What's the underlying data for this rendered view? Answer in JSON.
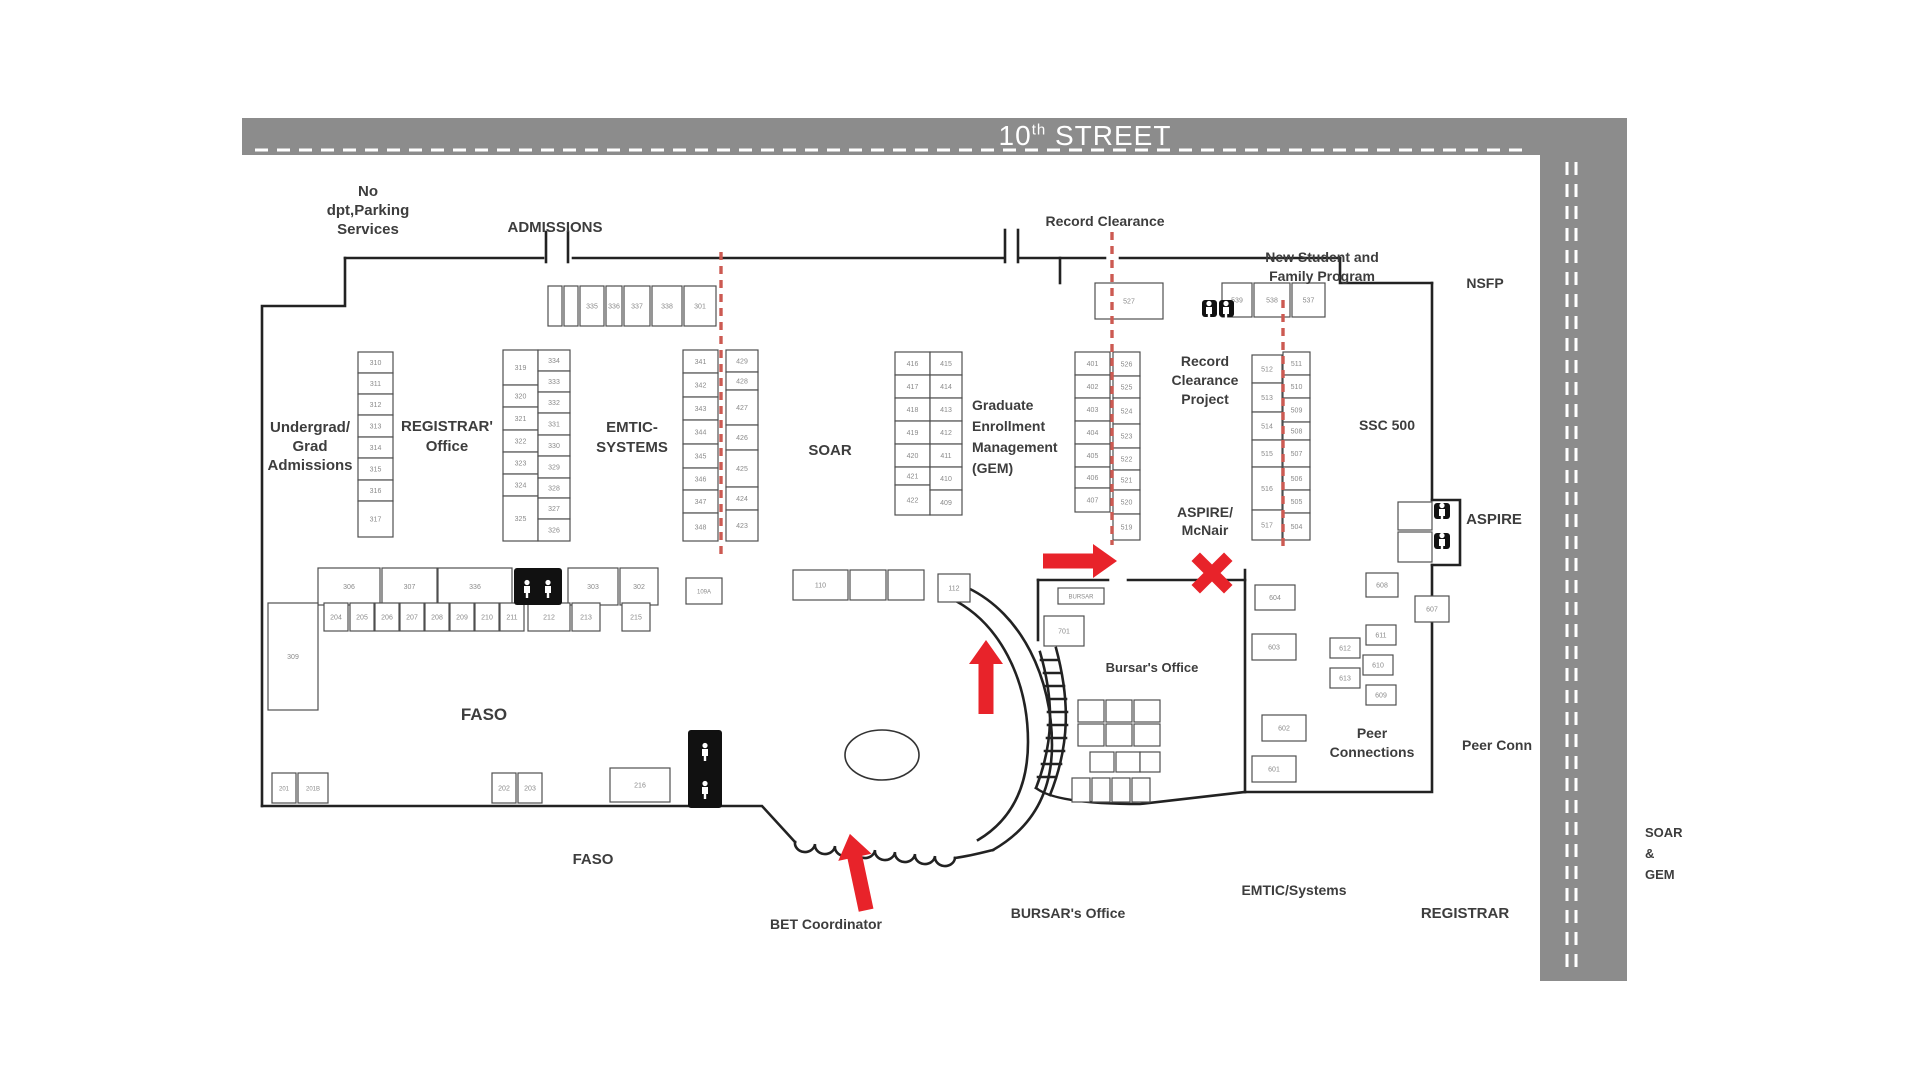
{
  "colors": {
    "road": "#8c8c8c",
    "wall": "#222222",
    "room_stroke": "#4f4f4f",
    "room_text": "#8a8a8a",
    "label": "#3d3d3d",
    "red": "#e8232a",
    "red_dash": "#cc5a52",
    "white": "#ffffff"
  },
  "street": {
    "number": "10",
    "sup": "th",
    "name": " STREET"
  },
  "roads": {
    "top": {
      "x": 242,
      "y": 118,
      "w": 1385,
      "h": 37
    },
    "right": {
      "x": 1540,
      "y": 118,
      "w": 87,
      "h": 863
    }
  },
  "road_dashes": [
    {
      "x1": 255,
      "y1": 150,
      "x2": 1530,
      "y2": 150
    },
    {
      "x1": 1567,
      "y1": 162,
      "x2": 1567,
      "y2": 975
    },
    {
      "x1": 1576,
      "y1": 162,
      "x2": 1576,
      "y2": 975
    }
  ],
  "area_labels": [
    {
      "id": "no-dpt-parking-services",
      "x": 368,
      "y": 196,
      "lh": 19,
      "size": 15,
      "align": "middle",
      "lines": [
        "No",
        "dpt,Parking",
        "Services"
      ]
    },
    {
      "id": "admissions",
      "x": 555,
      "y": 232,
      "lh": 19,
      "size": 15,
      "align": "middle",
      "lines": [
        "ADMISSIONS"
      ]
    },
    {
      "id": "record-clearance",
      "x": 1105,
      "y": 226,
      "lh": 18,
      "size": 14,
      "align": "middle",
      "lines": [
        "Record Clearance"
      ]
    },
    {
      "id": "new-student-family-program",
      "x": 1322,
      "y": 262,
      "lh": 19,
      "size": 14,
      "align": "middle",
      "lines": [
        "New Student and",
        "Family Program"
      ]
    },
    {
      "id": "nsfp",
      "x": 1485,
      "y": 288,
      "lh": 18,
      "size": 14,
      "align": "middle",
      "lines": [
        "NSFP"
      ]
    },
    {
      "id": "undergrad-grad-admissions",
      "x": 310,
      "y": 432,
      "lh": 19,
      "size": 15,
      "align": "middle",
      "lines": [
        "Undergrad/",
        "Grad",
        "Admissions"
      ]
    },
    {
      "id": "registrar-office",
      "x": 447,
      "y": 431,
      "lh": 20,
      "size": 15,
      "align": "middle",
      "lines": [
        "REGISTRAR'",
        "Office"
      ]
    },
    {
      "id": "emtic-systems",
      "x": 632,
      "y": 432,
      "lh": 20,
      "size": 15,
      "align": "middle",
      "lines": [
        "EMTIC-",
        "SYSTEMS"
      ]
    },
    {
      "id": "soar",
      "x": 830,
      "y": 455,
      "lh": 19,
      "size": 15,
      "align": "middle",
      "lines": [
        "SOAR"
      ]
    },
    {
      "id": "gem",
      "x": 972,
      "y": 410,
      "lh": 21,
      "size": 14,
      "align": "start",
      "lines": [
        "Graduate",
        "Enrollment",
        "Management",
        "(GEM)"
      ]
    },
    {
      "id": "record-clearance-project",
      "x": 1205,
      "y": 366,
      "lh": 19,
      "size": 14,
      "align": "middle",
      "lines": [
        "Record",
        "Clearance",
        "Project"
      ]
    },
    {
      "id": "ssc-500",
      "x": 1387,
      "y": 430,
      "lh": 18,
      "size": 14,
      "align": "middle",
      "lines": [
        "SSC 500"
      ]
    },
    {
      "id": "aspire-mcnair",
      "x": 1205,
      "y": 517,
      "lh": 18,
      "size": 14,
      "align": "middle",
      "lines": [
        "ASPIRE/",
        "McNair"
      ]
    },
    {
      "id": "aspire",
      "x": 1494,
      "y": 524,
      "lh": 18,
      "size": 15,
      "align": "middle",
      "lines": [
        "ASPIRE"
      ]
    },
    {
      "id": "bursars-office-mid",
      "x": 1152,
      "y": 672,
      "lh": 17,
      "size": 13,
      "align": "middle",
      "lines": [
        "Bursar's Office"
      ]
    },
    {
      "id": "peer-connections",
      "x": 1372,
      "y": 738,
      "lh": 19,
      "size": 14,
      "align": "middle",
      "lines": [
        "Peer",
        "Connections"
      ]
    },
    {
      "id": "peer-conn",
      "x": 1497,
      "y": 750,
      "lh": 18,
      "size": 14,
      "align": "middle",
      "lines": [
        "Peer Conn"
      ]
    },
    {
      "id": "faso",
      "x": 484,
      "y": 720,
      "lh": 20,
      "size": 17,
      "align": "middle",
      "lines": [
        "FASO"
      ]
    },
    {
      "id": "faso-2",
      "x": 593,
      "y": 864,
      "lh": 18,
      "size": 15,
      "align": "middle",
      "lines": [
        "FASO"
      ]
    },
    {
      "id": "bet-coordinator",
      "x": 826,
      "y": 929,
      "lh": 18,
      "size": 14,
      "align": "middle",
      "lines": [
        "BET Coordinator"
      ]
    },
    {
      "id": "bursars-office-bottom",
      "x": 1068,
      "y": 918,
      "lh": 18,
      "size": 14,
      "align": "middle",
      "lines": [
        "BURSAR's Office"
      ]
    },
    {
      "id": "emtic-systems-bottom",
      "x": 1294,
      "y": 895,
      "lh": 18,
      "size": 14,
      "align": "middle",
      "lines": [
        "EMTIC/Systems"
      ]
    },
    {
      "id": "registrar-bottom",
      "x": 1465,
      "y": 918,
      "lh": 18,
      "size": 15,
      "align": "middle",
      "lines": [
        "REGISTRAR"
      ]
    },
    {
      "id": "soar-gem",
      "x": 1645,
      "y": 837,
      "lh": 21,
      "size": 13,
      "align": "start",
      "lines": [
        "SOAR",
        "&",
        "GEM"
      ]
    }
  ],
  "rooms": [
    [
      "335",
      580,
      286,
      24,
      40
    ],
    [
      "336",
      606,
      286,
      16,
      40
    ],
    [
      "337",
      624,
      286,
      26,
      40
    ],
    [
      "338",
      652,
      286,
      30,
      40
    ],
    [
      "301",
      684,
      286,
      32,
      40
    ],
    [
      "310",
      358,
      352,
      35,
      21
    ],
    [
      "311",
      358,
      373,
      35,
      21
    ],
    [
      "312",
      358,
      394,
      35,
      21
    ],
    [
      "313",
      358,
      415,
      35,
      22
    ],
    [
      "314",
      358,
      437,
      35,
      21
    ],
    [
      "315",
      358,
      458,
      35,
      22
    ],
    [
      "316",
      358,
      480,
      35,
      21
    ],
    [
      "317",
      358,
      501,
      35,
      36
    ],
    [
      "319",
      503,
      350,
      35,
      35
    ],
    [
      "320",
      503,
      385,
      35,
      22
    ],
    [
      "321",
      503,
      407,
      35,
      23
    ],
    [
      "322",
      503,
      430,
      35,
      22
    ],
    [
      "323",
      503,
      452,
      35,
      22
    ],
    [
      "324",
      503,
      474,
      35,
      22
    ],
    [
      "325",
      503,
      496,
      35,
      45
    ],
    [
      "334",
      538,
      350,
      32,
      21
    ],
    [
      "333",
      538,
      371,
      32,
      21
    ],
    [
      "332",
      538,
      392,
      32,
      21
    ],
    [
      "331",
      538,
      413,
      32,
      22
    ],
    [
      "330",
      538,
      435,
      32,
      21
    ],
    [
      "329",
      538,
      456,
      32,
      22
    ],
    [
      "328",
      538,
      478,
      32,
      20
    ],
    [
      "327",
      538,
      498,
      32,
      21
    ],
    [
      "326",
      538,
      519,
      32,
      22
    ],
    [
      "341",
      683,
      350,
      35,
      23
    ],
    [
      "342",
      683,
      373,
      35,
      24
    ],
    [
      "343",
      683,
      397,
      35,
      23
    ],
    [
      "344",
      683,
      420,
      35,
      24
    ],
    [
      "345",
      683,
      444,
      35,
      24
    ],
    [
      "346",
      683,
      468,
      35,
      22
    ],
    [
      "347",
      683,
      490,
      35,
      23
    ],
    [
      "348",
      683,
      513,
      35,
      28
    ],
    [
      "429",
      726,
      350,
      32,
      22
    ],
    [
      "428",
      726,
      372,
      32,
      18
    ],
    [
      "427",
      726,
      390,
      32,
      35
    ],
    [
      "426",
      726,
      425,
      32,
      25
    ],
    [
      "425",
      726,
      450,
      32,
      37
    ],
    [
      "424",
      726,
      487,
      32,
      23
    ],
    [
      "423",
      726,
      510,
      32,
      31
    ],
    [
      "416",
      895,
      352,
      35,
      23
    ],
    [
      "417",
      895,
      375,
      35,
      23
    ],
    [
      "418",
      895,
      398,
      35,
      23
    ],
    [
      "419",
      895,
      421,
      35,
      23
    ],
    [
      "420",
      895,
      444,
      35,
      23
    ],
    [
      "421",
      895,
      467,
      35,
      18
    ],
    [
      "422",
      895,
      485,
      35,
      30
    ],
    [
      "415",
      930,
      352,
      32,
      23
    ],
    [
      "414",
      930,
      375,
      32,
      23
    ],
    [
      "413",
      930,
      398,
      32,
      23
    ],
    [
      "412",
      930,
      421,
      32,
      23
    ],
    [
      "411",
      930,
      444,
      32,
      23
    ],
    [
      "410",
      930,
      467,
      32,
      23
    ],
    [
      "409",
      930,
      490,
      32,
      25
    ],
    [
      "401",
      1075,
      352,
      35,
      23
    ],
    [
      "402",
      1075,
      375,
      35,
      23
    ],
    [
      "403",
      1075,
      398,
      35,
      23
    ],
    [
      "404",
      1075,
      421,
      35,
      23
    ],
    [
      "405",
      1075,
      444,
      35,
      23
    ],
    [
      "406",
      1075,
      467,
      35,
      21
    ],
    [
      "407",
      1075,
      488,
      35,
      24
    ],
    [
      "526",
      1113,
      352,
      27,
      24
    ],
    [
      "525",
      1113,
      376,
      27,
      22
    ],
    [
      "524",
      1113,
      398,
      27,
      26
    ],
    [
      "523",
      1113,
      424,
      27,
      24
    ],
    [
      "522",
      1113,
      448,
      27,
      22
    ],
    [
      "521",
      1113,
      470,
      27,
      20
    ],
    [
      "520",
      1113,
      490,
      27,
      24
    ],
    [
      "519",
      1113,
      514,
      27,
      26
    ],
    [
      "527",
      1095,
      283,
      68,
      36
    ],
    [
      "539",
      1222,
      283,
      30,
      34
    ],
    [
      "538",
      1254,
      283,
      36,
      34
    ],
    [
      "537",
      1292,
      283,
      33,
      34
    ],
    [
      "512",
      1252,
      355,
      30,
      28
    ],
    [
      "513",
      1252,
      383,
      30,
      29
    ],
    [
      "514",
      1252,
      412,
      30,
      28
    ],
    [
      "515",
      1252,
      440,
      30,
      27
    ],
    [
      "516",
      1252,
      467,
      30,
      43
    ],
    [
      "517",
      1252,
      510,
      30,
      30
    ],
    [
      "511",
      1283,
      352,
      27,
      23
    ],
    [
      "510",
      1283,
      375,
      27,
      23
    ],
    [
      "509",
      1283,
      398,
      27,
      24
    ],
    [
      "508",
      1283,
      422,
      27,
      18
    ],
    [
      "507",
      1283,
      440,
      27,
      27
    ],
    [
      "506",
      1283,
      467,
      27,
      23
    ],
    [
      "505",
      1283,
      490,
      27,
      23
    ],
    [
      "504",
      1283,
      513,
      27,
      27
    ],
    [
      "306",
      318,
      568,
      62,
      37
    ],
    [
      "307",
      382,
      568,
      55,
      37
    ],
    [
      "336",
      438,
      568,
      74,
      37
    ],
    [
      "303",
      568,
      568,
      50,
      37
    ],
    [
      "302",
      620,
      568,
      38,
      37
    ],
    [
      "109A",
      686,
      578,
      36,
      26,
      6
    ],
    [
      "204",
      324,
      603,
      24,
      28
    ],
    [
      "205",
      350,
      603,
      24,
      28
    ],
    [
      "206",
      375,
      603,
      24,
      28
    ],
    [
      "207",
      400,
      603,
      24,
      28
    ],
    [
      "208",
      425,
      603,
      24,
      28
    ],
    [
      "209",
      450,
      603,
      24,
      28
    ],
    [
      "210",
      475,
      603,
      24,
      28
    ],
    [
      "211",
      500,
      603,
      24,
      28
    ],
    [
      "212",
      528,
      603,
      42,
      28
    ],
    [
      "213",
      572,
      603,
      28,
      28
    ],
    [
      "215",
      622,
      603,
      28,
      28
    ],
    [
      "309",
      268,
      603,
      50,
      107
    ],
    [
      "201",
      272,
      773,
      24,
      30,
      6
    ],
    [
      "201B",
      298,
      773,
      30,
      30,
      6
    ],
    [
      "202",
      492,
      773,
      24,
      30
    ],
    [
      "203",
      518,
      773,
      24,
      30
    ],
    [
      "216",
      610,
      768,
      60,
      34
    ],
    [
      "110",
      793,
      570,
      55,
      30
    ],
    [
      "112",
      938,
      574,
      32,
      28
    ],
    [
      "701",
      1044,
      616,
      40,
      30
    ],
    [
      "BURSAR",
      1058,
      588,
      46,
      16,
      6
    ],
    [
      "604",
      1255,
      585,
      40,
      25
    ],
    [
      "608",
      1366,
      573,
      32,
      24
    ],
    [
      "607",
      1415,
      596,
      34,
      26
    ],
    [
      "603",
      1252,
      634,
      44,
      26
    ],
    [
      "611",
      1366,
      625,
      30,
      20
    ],
    [
      "612",
      1330,
      638,
      30,
      20
    ],
    [
      "610",
      1363,
      655,
      30,
      20
    ],
    [
      "613",
      1330,
      668,
      30,
      20
    ],
    [
      "609",
      1366,
      685,
      30,
      20
    ],
    [
      "602",
      1262,
      715,
      44,
      26
    ],
    [
      "601",
      1252,
      756,
      44,
      26
    ]
  ],
  "cells": [
    [
      548,
      286,
      14,
      40
    ],
    [
      564,
      286,
      14,
      40
    ],
    [
      850,
      570,
      36,
      30
    ],
    [
      888,
      570,
      36,
      30
    ],
    [
      1078,
      700,
      26,
      22
    ],
    [
      1106,
      700,
      26,
      22
    ],
    [
      1134,
      700,
      26,
      22
    ],
    [
      1078,
      724,
      26,
      22
    ],
    [
      1106,
      724,
      26,
      22
    ],
    [
      1134,
      724,
      26,
      22
    ],
    [
      1090,
      752,
      24,
      20
    ],
    [
      1116,
      752,
      24,
      20
    ],
    [
      1140,
      752,
      20,
      20
    ],
    [
      1072,
      778,
      18,
      24
    ],
    [
      1092,
      778,
      18,
      24
    ],
    [
      1112,
      778,
      18,
      24
    ],
    [
      1132,
      778,
      18,
      24
    ],
    [
      1398,
      502,
      34,
      28
    ],
    [
      1398,
      532,
      34,
      30
    ]
  ],
  "restrooms": [
    {
      "x": 514,
      "y": 568,
      "w": 48,
      "h": 37,
      "figs": [
        [
          527,
          589
        ],
        [
          548,
          589
        ]
      ]
    },
    {
      "x": 688,
      "y": 730,
      "w": 34,
      "h": 78,
      "figs": [
        [
          705,
          752
        ],
        [
          705,
          790
        ]
      ]
    },
    {
      "x": 1202,
      "y": 300,
      "w": 15,
      "h": 17,
      "figs": [
        [
          1209,
          310
        ]
      ]
    },
    {
      "x": 1219,
      "y": 300,
      "w": 15,
      "h": 17,
      "figs": [
        [
          1226,
          310
        ]
      ]
    },
    {
      "x": 1434,
      "y": 503,
      "w": 16,
      "h": 16,
      "figs": [
        [
          1442,
          512
        ]
      ]
    },
    {
      "x": 1434,
      "y": 533,
      "w": 16,
      "h": 16,
      "figs": [
        [
          1442,
          542
        ]
      ]
    }
  ],
  "walls": [
    "M345,258 H543",
    "M573,258 H1003",
    "M1020,258 H1105",
    "M1120,258 H1340",
    "M1340,258 V283 H1432",
    "M345,258 V306 H262 V806",
    "M546,232 V262",
    "M568,232 V262",
    "M1005,230 V262",
    "M1018,230 V262",
    "M262,806 H700",
    "M700,806 H762 L795,842",
    "M1432,283 V500",
    "M1432,500 H1460 V565 H1432",
    "M1432,565 V792 H1245",
    "M1245,570 V792",
    "M1038,580 H1108",
    "M1128,580 H1245",
    "M1038,580 V640",
    "M1060,258 V283",
    "M950,598 C1000,622 1028,680 1028,742 C1028,792 1008,822 978,840",
    "M968,588 C1022,614 1052,678 1052,745 C1052,797 1028,830 993,850",
    "M1056,648 C1070,700 1070,745 1050,795",
    "M1040,652 C1054,700 1054,742 1036,788",
    "M1041,660 H1058",
    "M1044,673 H1061",
    "M1046,686 H1064",
    "M1048,699 H1066",
    "M1048,712 H1067",
    "M1048,725 H1067",
    "M1047,738 H1066",
    "M1045,751 H1064",
    "M1042,764 H1061",
    "M1038,777 H1056",
    "M795,842 a10,9 0 0 0 20,2 a10,9 0 0 0 20,2 a10,9 0 0 0 20,2 a10,9 0 0 0 20,2 a10,9 0 0 0 20,2 a10,9 0 0 0 20,2 a10,9 0 0 0 20,2 a10,9 0 0 0 20,2",
    "M955,858 C970,856 985,852 993,850",
    "M1036,788 C1050,800 1090,804 1140,804 L1245,792"
  ],
  "ellipse": {
    "cx": 882,
    "cy": 755,
    "rx": 37,
    "ry": 25
  },
  "red": {
    "dashes": [
      {
        "x": 721,
        "y1": 252,
        "y2": 558
      },
      {
        "x": 1112,
        "y1": 232,
        "y2": 545
      },
      {
        "x": 1283,
        "y1": 300,
        "y2": 552
      }
    ],
    "arrows": [
      {
        "id": "arrow-to-bursar",
        "cx": 1080,
        "cy": 561,
        "len": 74,
        "rot": 0
      },
      {
        "id": "arrow-up-corridor",
        "cx": 986,
        "cy": 677,
        "len": 74,
        "rot": -90
      },
      {
        "id": "arrow-bet-entrance",
        "cx": 858,
        "cy": 872,
        "len": 78,
        "rot": -102
      }
    ],
    "cross": {
      "cx": 1212,
      "cy": 573,
      "arm": 46,
      "bar": 12
    }
  }
}
